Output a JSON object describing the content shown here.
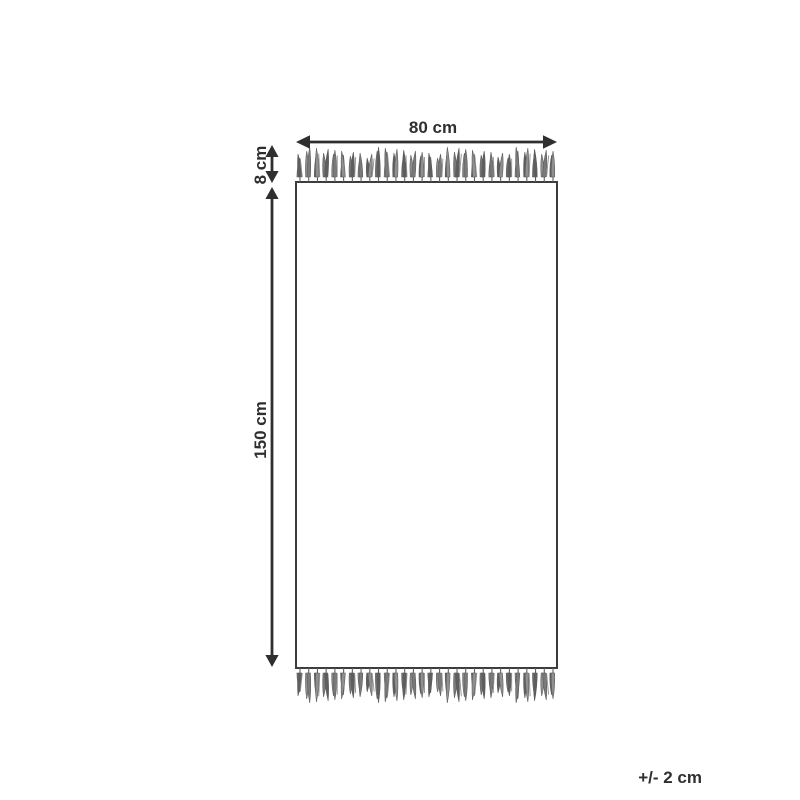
{
  "diagram": {
    "name": "rug-dimensions-diagram",
    "labels": {
      "width": "80 cm",
      "fringe_height": "8 cm",
      "length": "150 cm",
      "tolerance": "+/- 2 cm"
    },
    "dimensions": {
      "width_value": "80 cm",
      "fringe_value": "8 cm",
      "length_value": "150 cm",
      "tolerance_value": "+/- 2 cm"
    },
    "colors": {
      "line": "#2f2f2f",
      "outline": "#3c3c3c",
      "tassel_dark": "#5e5e5e",
      "tassel": "#7a7a7a",
      "tassel_light": "#8f8f8f",
      "background": "#ffffff"
    },
    "fringe": {
      "tassel_count": 30
    }
  }
}
